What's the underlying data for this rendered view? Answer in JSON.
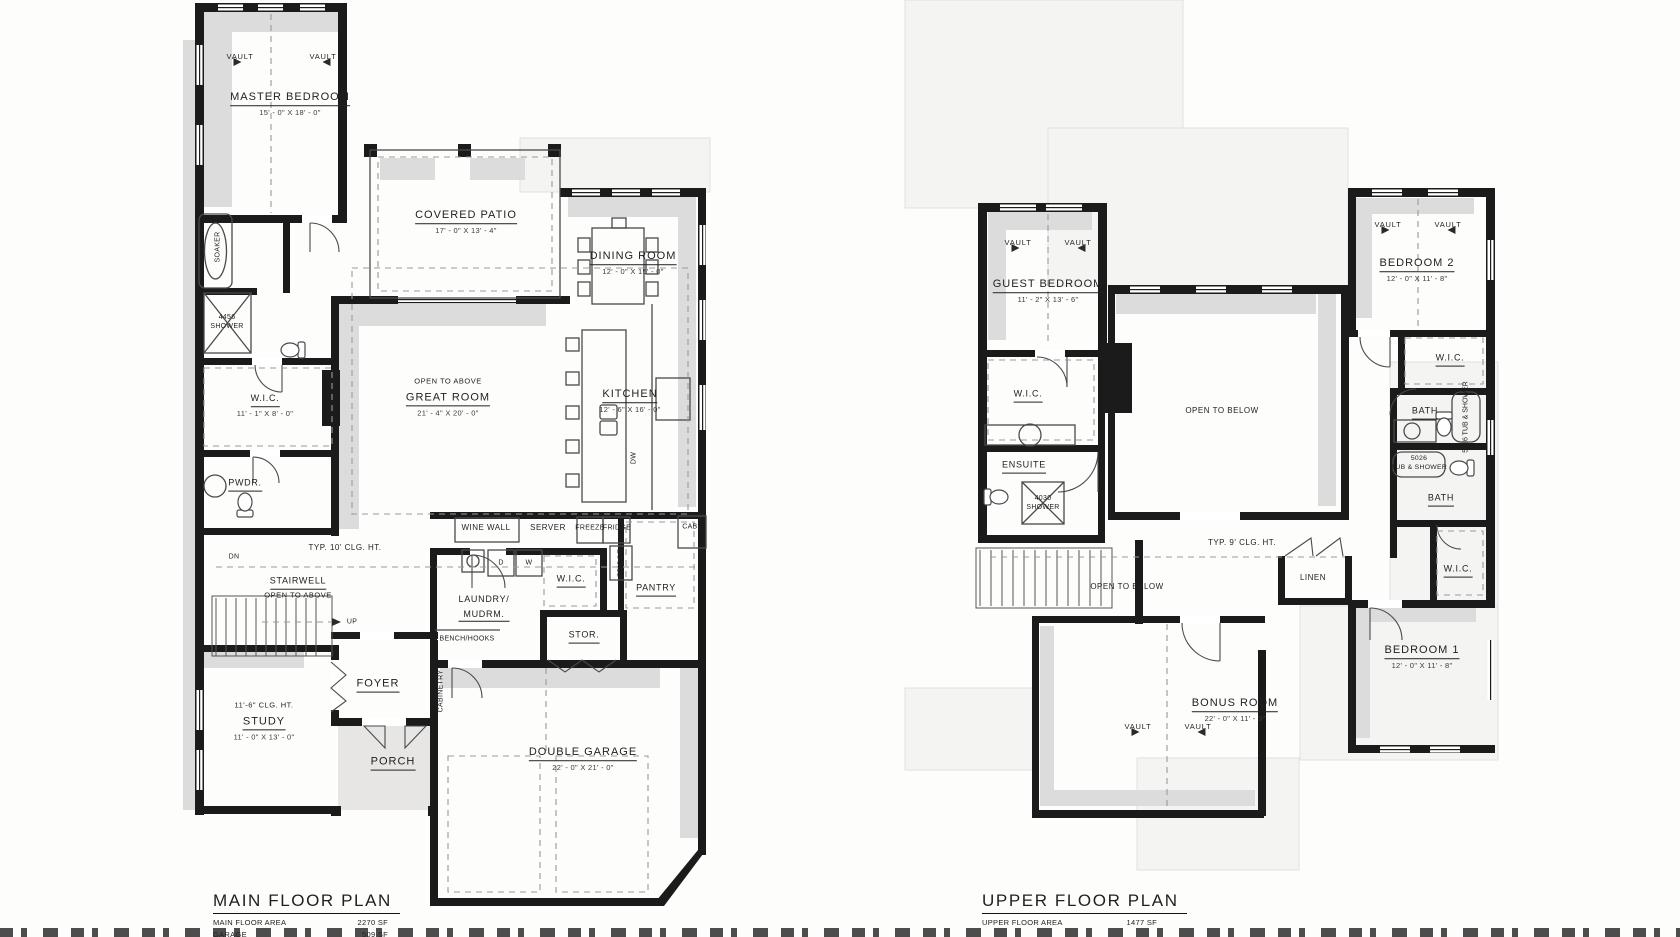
{
  "sheet": {
    "type_note": "architectural floor plan drawing"
  },
  "colors": {
    "wall": "#1b1b1b",
    "shadow": "#dcdcdc",
    "dash": "#9a9a9a",
    "paper": "#fdfdfc",
    "faint": "#f4f4f3",
    "text": "#1f1f1f"
  },
  "main_plan": {
    "title": "MAIN FLOOR PLAN",
    "stats": [
      {
        "label": "MAIN FLOOR AREA",
        "value": "2270 SF"
      },
      {
        "label": "GARAGE",
        "value": "509 SF"
      },
      {
        "label": "TOTAL MAIN FLOOR AREA",
        "value": "2780 SF"
      }
    ],
    "vaults": [
      "VAULT",
      "VAULT"
    ],
    "rooms": {
      "master": {
        "name": "MASTER BEDROOM",
        "dims": "15' - 0\" X 18' - 0\""
      },
      "wic_master": {
        "name": "W.I.C.",
        "dims": "11' - 1\" X 8' - 0\""
      },
      "covered_patio": {
        "name": "COVERED PATIO",
        "dims": "17' - 0\" X 13' - 4\""
      },
      "dining": {
        "name": "DINING ROOM",
        "dims": "12' - 0\" X 15' - 0\""
      },
      "great": {
        "note": "OPEN TO ABOVE",
        "name": "GREAT ROOM",
        "dims": "21' - 4\" X 20' - 0\""
      },
      "kitchen": {
        "name": "KITCHEN",
        "dims": "12' - 6\" X 16' - 0\""
      },
      "stairwell": {
        "name": "STAIRWELL",
        "note": "OPEN TO ABOVE"
      },
      "laundry": {
        "line1": "LAUNDRY/",
        "line2": "MUDRM."
      },
      "study": {
        "note": "11'-6\" CLG. HT.",
        "name": "STUDY",
        "dims": "11' - 0\" X 13' - 0\""
      },
      "garage": {
        "name": "DOUBLE GARAGE",
        "dims": "22' - 0\" X 21' - 0\""
      },
      "foyer": "FOYER",
      "porch": "PORCH",
      "pwdr": "PWDR.",
      "stor": "STOR.",
      "pantry": "PANTRY",
      "wic_mud": "W.I.C.",
      "bench": "BENCH/HOOKS",
      "cabinetry": "CABINETRY",
      "soaker": "SOAKER",
      "shower": {
        "line1": "4456",
        "line2": "SHOWER"
      }
    },
    "fixtures": {
      "wine_wall": "WINE WALL",
      "server": "SERVER",
      "freeze": "FREEZE",
      "fridge": "FRIDGE",
      "cab": "CAB.",
      "fridge_vert": "FRIDGE",
      "dw": "DW",
      "d": "D",
      "w": "W"
    },
    "notes": {
      "clg": "TYP. 10' CLG. HT.",
      "up": "UP",
      "dn": "DN"
    }
  },
  "upper_plan": {
    "title": "UPPER FLOOR PLAN",
    "stats": [
      {
        "label": "UPPER FLOOR AREA",
        "value": "1477 SF"
      }
    ],
    "vaults": [
      "VAULT",
      "VAULT",
      "VAULT",
      "VAULT",
      "VAULT",
      "VAULT"
    ],
    "rooms": {
      "guest": {
        "name": "GUEST BEDROOM",
        "dims": "11' - 2\" X 13' - 6\""
      },
      "bedroom2": {
        "name": "BEDROOM 2",
        "dims": "12' - 0\" X 11' - 8\""
      },
      "bedroom1": {
        "name": "BEDROOM 1",
        "dims": "12' - 0\" X 11' - 8\""
      },
      "bonus": {
        "name": "BONUS ROOM",
        "dims": "22' - 0\" X 11' - 3\""
      },
      "wic_guest": "W.I.C.",
      "ensuite": "ENSUITE",
      "shower": {
        "line1": "4030",
        "line2": "SHOWER"
      },
      "wic_bed2": "W.I.C.",
      "bath1": "BATH",
      "bath2": "BATH",
      "wic_bed1": "W.I.C.",
      "linen": "LINEN",
      "tub_vert": "5026 TUB & SHOWER",
      "tub2": {
        "line1": "5026",
        "line2": "TUB & SHOWER"
      },
      "open_below_great": "OPEN TO BELOW",
      "open_below_stair": "OPEN TO BELOW"
    },
    "notes": {
      "clg": "TYP. 9' CLG. HT."
    }
  }
}
